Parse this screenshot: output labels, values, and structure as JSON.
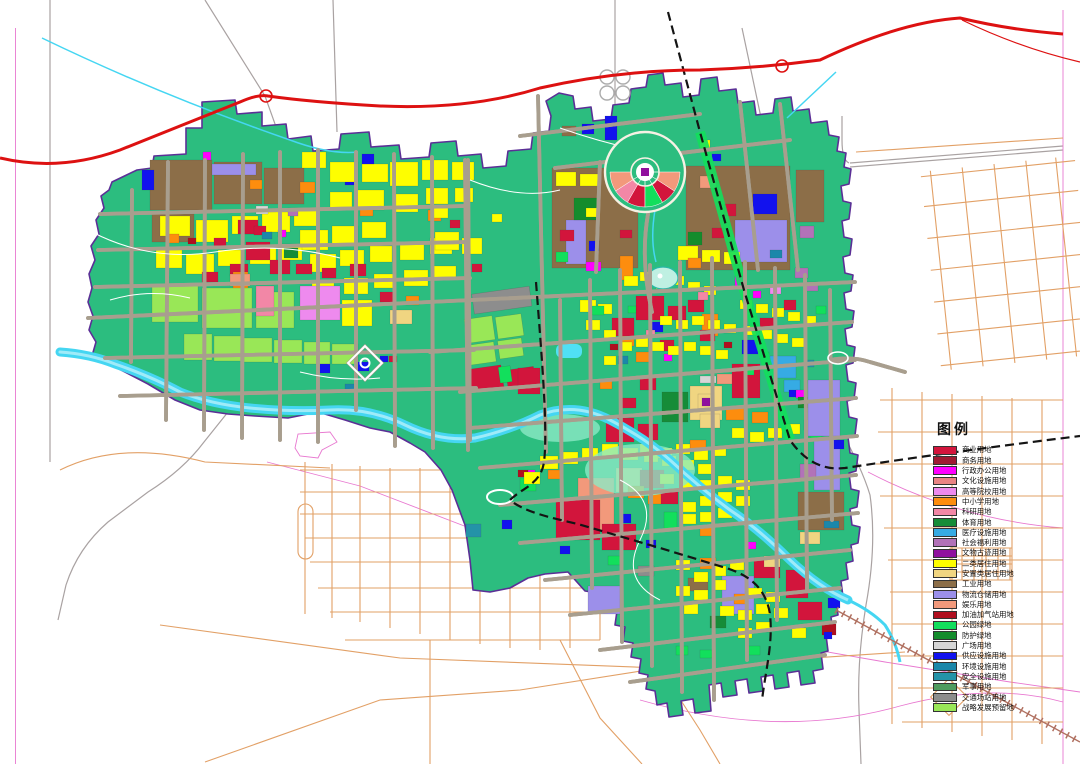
{
  "legend": {
    "title": "图例",
    "items": [
      {
        "label": "商业用地",
        "color": "#D2153C"
      },
      {
        "label": "商务用地",
        "color": "#9E1B32"
      },
      {
        "label": "行政办公用地",
        "color": "#FF00FF"
      },
      {
        "label": "文化设施用地",
        "color": "#E98484"
      },
      {
        "label": "高等院校用地",
        "color": "#EE8AEE"
      },
      {
        "label": "中小学用地",
        "color": "#FD8D0E"
      },
      {
        "label": "科研用地",
        "color": "#F287A6"
      },
      {
        "label": "体育用地",
        "color": "#168C38"
      },
      {
        "label": "医疗设施用地",
        "color": "#36ABE4"
      },
      {
        "label": "社会福利用地",
        "color": "#B272B8"
      },
      {
        "label": "文物古迹用地",
        "color": "#90109E"
      },
      {
        "label": "二类居住用地",
        "color": "#FEFE00"
      },
      {
        "label": "安置类居住用地",
        "color": "#F0D581"
      },
      {
        "label": "工业用地",
        "color": "#8C6E48"
      },
      {
        "label": "物流仓储用地",
        "color": "#9C8FEA"
      },
      {
        "label": "娱乐用地",
        "color": "#F2997B"
      },
      {
        "label": "加油加气站用地",
        "color": "#B00F1F"
      },
      {
        "label": "公园绿地",
        "color": "#12DF5C"
      },
      {
        "label": "防护绿地",
        "color": "#148C2C"
      },
      {
        "label": "广场用地",
        "color": "#D6D6D6"
      },
      {
        "label": "供应设施用地",
        "color": "#1212EE"
      },
      {
        "label": "环境设施用地",
        "color": "#1B87AA"
      },
      {
        "label": "安全设施用地",
        "color": "#2493A8"
      },
      {
        "label": "军事用地",
        "color": "#4F9C5F"
      },
      {
        "label": "交通场站用地",
        "color": "#8D8D8D"
      },
      {
        "label": "战略发展预留地",
        "color": "#99E757"
      }
    ]
  },
  "map": {
    "base_green": "#2CBD7F",
    "boundary_color": "#5B2F96",
    "highway_color": "#DD1111",
    "railway_color": "#141414",
    "river_color": "#45D6F2",
    "river_highlight": "#9FEBF8",
    "outside_road_color": "#E2A066",
    "inner_road_fill": "#F6F1E4",
    "inner_road_edge": "#A89E8E",
    "frame_line_color": "#E878D0",
    "rail_tie_color": "#B07060"
  }
}
